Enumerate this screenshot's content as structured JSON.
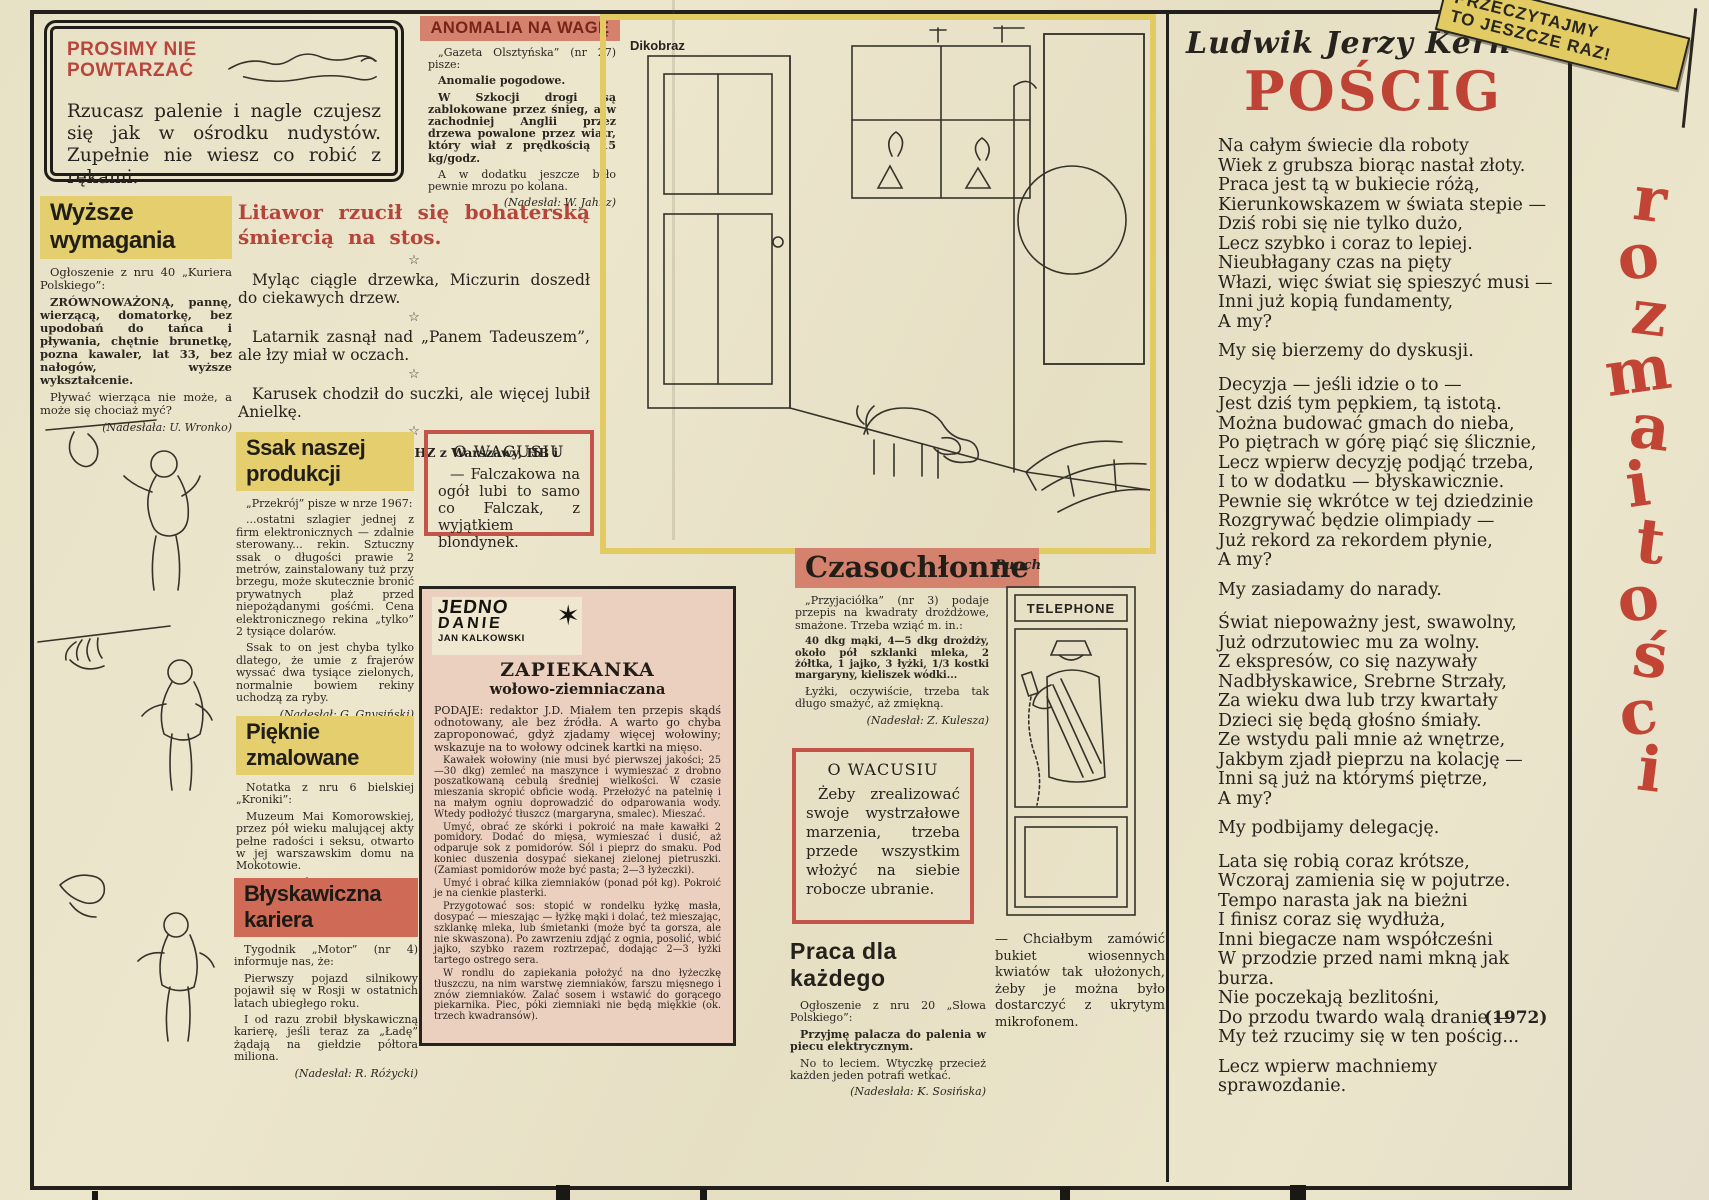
{
  "palette": {
    "paper": "#e9e3cb",
    "ink": "#26231e",
    "red": "#b9453c",
    "yellow": "#e4ce6e",
    "salmon": "#d4826e",
    "recipe_pink": "#ecd0bf",
    "frame_yellow": "#e3cb63"
  },
  "page": {
    "vertical_title": "rozmaitości",
    "banner_line1": "PRZECZYTAJMY",
    "banner_line2": "TO JESZCZE RAZ!",
    "year": "(1972)"
  },
  "prosimy": {
    "title": "PROSIMY NIE POWTARZAĆ",
    "body": "Rzucasz palenie i nagle czujesz się jak w ośrodku nudystów. Zupełnie nie wiesz co robić z rękami."
  },
  "wyzsze": {
    "title": "Wyższe wymagania",
    "intro": "Ogłoszenie z nru 40 „Kuriera Polskiego”:",
    "p1": "ZRÓWNOWAŻONĄ, pannę, wierzącą, domatorkę, bez upodobań do tańca i pływania, chętnie brunetkę, pozna kawaler, lat 33, bez nałogów, wyższe wykształcenie.",
    "p2": "Pływać wierząca nie może, a może się chociaż myć?",
    "credit": "(Nadesłała: U. Wronko)"
  },
  "anomalia": {
    "title": "ANOMALIA NA WAGĘ",
    "intro": "„Gazeta Olsztyńska” (nr 27) pisze:",
    "p1": "Anomalie pogodowe.",
    "p2": "W Szkocji drogi są zablokowane przez śnieg, a w zachodniej Anglii przez drzewa powalone przez wiatr, który wiał z prędkością 15 kg/godz.",
    "p3": "A w dodatku jeszcze było pewnie mrozu po kolana.",
    "credit": "(Nadesłał: W. Jahnz)"
  },
  "litawor": {
    "title": "Litawor rzucił się bohaterską śmiercią na stos.",
    "star": "☆",
    "jokes": [
      "Myląc ciągle drzewka, Miczurin doszedł do ciekawych drzew.",
      "Latarnik zasnął nad „Panem Tadeuszem”, ale łzy miał w oczach.",
      "Karusek chodził do suczki, ale więcej lubił Anielkę."
    ],
    "footer": "Z listów, które nadesłali: HZ z Warszawy, HB i Halina O. Dziękujemy."
  },
  "ssak": {
    "title": "Ssak naszej produkcji",
    "intro": "„Przekrój” pisze w nrze 1967:",
    "p1": "...ostatni szlagier jednej z firm elektronicznych — zdalnie sterowany... rekin. Sztuczny ssak o długości prawie 2 metrów, zainstalowany tuż przy brzegu, może skutecznie bronić prywatnych plaż przed niepożądanymi gośćmi. Cena elektronicznego rekina „tylko” 2 tysiące dolarów.",
    "p2": "Ssak to on jest chyba tylko dlatego, że umie z frajerów wyssać dwa tysiące zielonych, normalnie bowiem rekiny uchodzą za ryby.",
    "credit": "(Nadesłał: G. Gnysiński)"
  },
  "wacusiu1": {
    "title": "O WACUSIU",
    "body": "— Falczakowa na ogół lubi to samo co Falczak, z wyjątkiem blondynek."
  },
  "pieknie": {
    "title": "Pięknie zmalowane",
    "intro": "Notatka z nru 6 bielskiej „Kroniki”:",
    "p1": "Muzeum Mai Komorowskiej, przez pół wieku malującej akty pełne radości i seksu, otwarto w jej warszawskim domu na Mokotowie.",
    "p2": "Naszym zdaniem powinno to być kino-muzeum.",
    "credit": "(Nadesłał: W. Fox)"
  },
  "blyskawiczna": {
    "title": "Błyskawiczna kariera",
    "intro": "Tygodnik „Motor” (nr 4) informuje nas, że:",
    "p1": "Pierwszy pojazd silnikowy pojawił się w Rosji w ostatnich latach ubiegłego roku.",
    "p2": "I od razu zrobił błyskawiczną karierę, jeśli teraz za „Ładę” żądają na giełdzie półtora miliona.",
    "credit": "(Nadesłał: R. Różycki)"
  },
  "zapiekanka": {
    "logo_top": "JEDNO",
    "logo_mid": "DANIE",
    "logo_author": "JAN KALKOWSKI",
    "logo_burst": "✶",
    "title": "ZAPIEKANKA",
    "subtitle": "wołowo-ziemniaczana",
    "p1": "PODAJE: redaktor J.D. Miałem ten przepis skądś odnotowany, ale bez źródła. A warto go chyba zaproponować, gdyż zjadamy więcej wołowiny; wskazuje na to wołowy odcinek kartki na mięso.",
    "p2": "Kawałek wołowiny (nie musi być pierwszej jakości; 25—30 dkg) zemleć na maszynce i wymieszać z drobno poszatkowaną cebulą średniej wielkości. W czasie mieszania skropić obficie wodą. Przełożyć na patelnię i na małym ogniu doprowadzić do odparowania wody. Wtedy podłożyć tłuszcz (margaryna, smalec). Mieszać.",
    "p3": "Umyć, obrać ze skórki i pokroić na małe kawałki 2 pomidory. Dodać do mięsa, wymieszać i dusić, aż odparuje sok z pomidorów. Sól i pieprz do smaku. Pod koniec duszenia dosypać siekanej zielonej pietruszki. (Zamiast pomidorów może być pasta; 2—3 łyżeczki).",
    "p4": "Umyć i obrać kilka ziemniaków (ponad pół kg). Pokroić je na cienkie plasterki.",
    "p5": "Przygotować sos: stopić w rondelku łyżkę masła, dosypać — mieszając — łyżkę mąki i dolać, też mieszając, szklankę mleka, lub śmietanki (może być ta gorsza, ale nie skwaszona). Po zawrzeniu zdjąć z ognia, posolić, wbić jajko, szybko razem roztrzepać, dodając 2—3 łyżki tartego ostrego sera.",
    "p6": "W rondlu do zapiekania położyć na dno łyżeczkę tłuszczu, na nim warstwę ziemniaków, farszu mięsnego i znów ziemniaków. Zalać sosem i wstawić do gorącego piekarnika. Piec, póki ziemniaki nie będą miękkie (ok. trzech kwadransów)."
  },
  "czasochlonne": {
    "title": "Czasochłonne",
    "intro": "„Przyjaciółka” (nr 3) podaje przepis na kwadraty drożdżowe, smażone. Trzeba wziąć m. in.:",
    "p1": "40 dkg mąki, 4—5 dkg drożdży, około pół szklanki mleka, 2 żółtka, 1 jajko, 3 łyżki, 1/3 kostki margaryny, kieliszek wódki...",
    "p2": "Łyżki, oczywiście, trzeba tak długo smażyć, aż zmiękną.",
    "credit": "(Nadesłał: Z. Kulesza)"
  },
  "wacusiu2": {
    "title": "O WACUSIU",
    "body": "Żeby zrealizować swoje wystrzałowe marzenia, trzeba przede wszystkim włożyć na siebie robocze ubranie."
  },
  "praca": {
    "title": "Praca dla każdego",
    "intro": "Ogłoszenie z nru 20 „Słowa Polskiego”:",
    "p1": "Przyjmę palacza do palenia w piecu elektrycznym.",
    "p2": "No to leciem. Wtyczkę przecież każden jeden potrafi wetkać.",
    "credit": "(Nadesłała: K. Sosińska)"
  },
  "cartoon_dikobraz": {
    "label": "Dikobraz"
  },
  "cartoon_punch": {
    "label": "Punch",
    "sign": "TELEPHONE",
    "caption": "— Chciałbym zamówić bukiet wiosennych kwiatów tak ułożonych, żeby je można było dostarczyć z ukrytym mikrofonem."
  },
  "poem": {
    "author": "Ludwik Jerzy Kern",
    "title": "POŚCIG",
    "stanzas": [
      [
        "Na całym świecie dla roboty",
        "Wiek z grubsza biorąc nastał złoty.",
        "Praca jest tą w bukiecie różą,",
        "Kierunkowskazem w świata stepie —",
        "Dziś robi się nie tylko dużo,",
        "Lecz szybko i coraz to lepiej.",
        "Nieubłagany czas na pięty",
        "Włazi, więc świat się spieszyć musi —",
        "Inni już kopią fundamenty,",
        "A my?"
      ],
      [
        "My się bierzemy do dyskusji."
      ],
      [
        "Decyzja — jeśli idzie o to —",
        "Jest dziś tym pępkiem, tą istotą.",
        "Można budować gmach do nieba,",
        "Po piętrach w górę piąć się ślicznie,",
        "Lecz wpierw decyzję podjąć trzeba,",
        "I to w dodatku — błyskawicznie.",
        "Pewnie się wkrótce w tej dziedzinie",
        "Rozgrywać będzie olimpiady —",
        "Już rekord za rekordem płynie,",
        "A my?"
      ],
      [
        "My zasiadamy do narady."
      ],
      [
        "Świat niepoważny jest, swawolny,",
        "Już odrzutowiec mu za wolny.",
        "Z ekspresów, co się nazywały",
        "Nadbłyskawice, Srebrne Strzały,",
        "Za wieku dwa lub trzy kwartały",
        "Dzieci się będą głośno śmiały.",
        "Ze wstydu pali mnie aż wnętrze,",
        "Jakbym zjadł pieprzu na kolację —",
        "Inni są już na którymś piętrze,",
        "A my?"
      ],
      [
        "My podbijamy delegację."
      ],
      [
        "Lata się robią coraz krótsze,",
        "Wczoraj zamienia się w pojutrze.",
        "Tempo narasta jak na bieżni",
        "I finisz coraz się wydłuża,",
        "Inni biegacze nam współcześni",
        "W przodzie przed nami mkną jak burza.",
        "Nie poczekają bezlitośni,",
        "Do przodu twardo walą dranie —",
        "My też rzucimy się w ten pościg..."
      ],
      [
        "Lecz wpierw machniemy sprawozdanie."
      ]
    ]
  }
}
